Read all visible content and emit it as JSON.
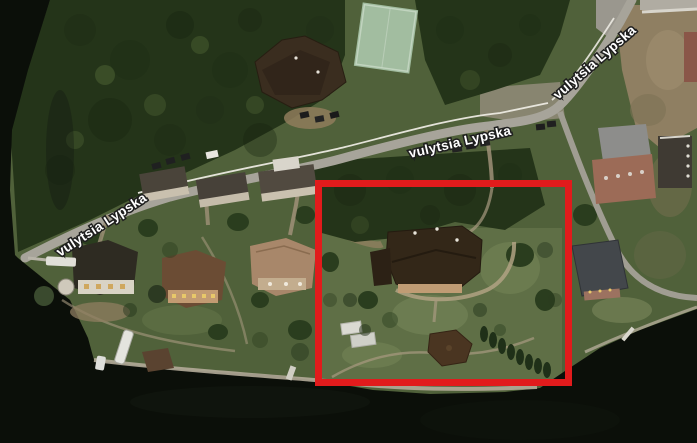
{
  "scene": {
    "kind": "satellite-aerial-imagery",
    "description": "Satellite view of a wooded riverside estate district along vulytsia Lypska; dark river water borders the left and bottom, a road lined by a white fence crosses diagonally, and a red rectangle highlights the central waterfront estate",
    "width_px": 697,
    "height_px": 443
  },
  "street_labels": [
    {
      "id": "street-label-west",
      "text": "vulytsia Lypska"
    },
    {
      "id": "street-label-center",
      "text": "vulytsia Lypska"
    },
    {
      "id": "street-label-northeast",
      "text": "vulytsia Lypska"
    }
  ],
  "annotation": {
    "shape": "rectangle",
    "color_hex": "#e11b1c",
    "left_px": 315,
    "top_px": 180,
    "width_px": 257,
    "height_px": 206,
    "stroke_px": 7,
    "purpose": "highlights the central waterfront estate"
  },
  "map_features": [
    {
      "name": "river-water",
      "color_hex": "#0b0f09"
    },
    {
      "name": "forest-canopy",
      "color_hex": "#243419"
    },
    {
      "name": "grass-lawn",
      "color_hex": "#556a3e"
    },
    {
      "name": "main-road",
      "color_hex": "#a7a49a"
    },
    {
      "name": "white-perimeter-fence",
      "color_hex": "#eceae2"
    },
    {
      "name": "tennis-court",
      "color_hex": "#a2bda0"
    },
    {
      "name": "large-mansion-north",
      "color_hex": "#3a2d1f"
    },
    {
      "name": "terraced-houses",
      "color_hex": "#4a443a"
    },
    {
      "name": "waterfront-mansion-white-facade",
      "color_hex": "#d9d3c5"
    },
    {
      "name": "waterfront-mansion-tan",
      "color_hex": "#6b4c34"
    },
    {
      "name": "waterfront-mansion-light-brown",
      "color_hex": "#a8876a"
    },
    {
      "name": "estate-main-house",
      "color_hex": "#332718"
    },
    {
      "name": "garden-pavilion",
      "color_hex": "#4a3521"
    },
    {
      "name": "greenhouse-sheds",
      "color_hex": "#dadad2"
    },
    {
      "name": "cypress-tree-row",
      "color_hex": "#1f3018"
    },
    {
      "name": "brick-mansion-east",
      "color_hex": "#9c6b57"
    },
    {
      "name": "gray-roof-building-east",
      "color_hex": "#43474b"
    },
    {
      "name": "dirt-lot-northeast",
      "color_hex": "#8f7f62"
    },
    {
      "name": "boats-and-piers",
      "color_hex": "#e4e4de"
    }
  ]
}
